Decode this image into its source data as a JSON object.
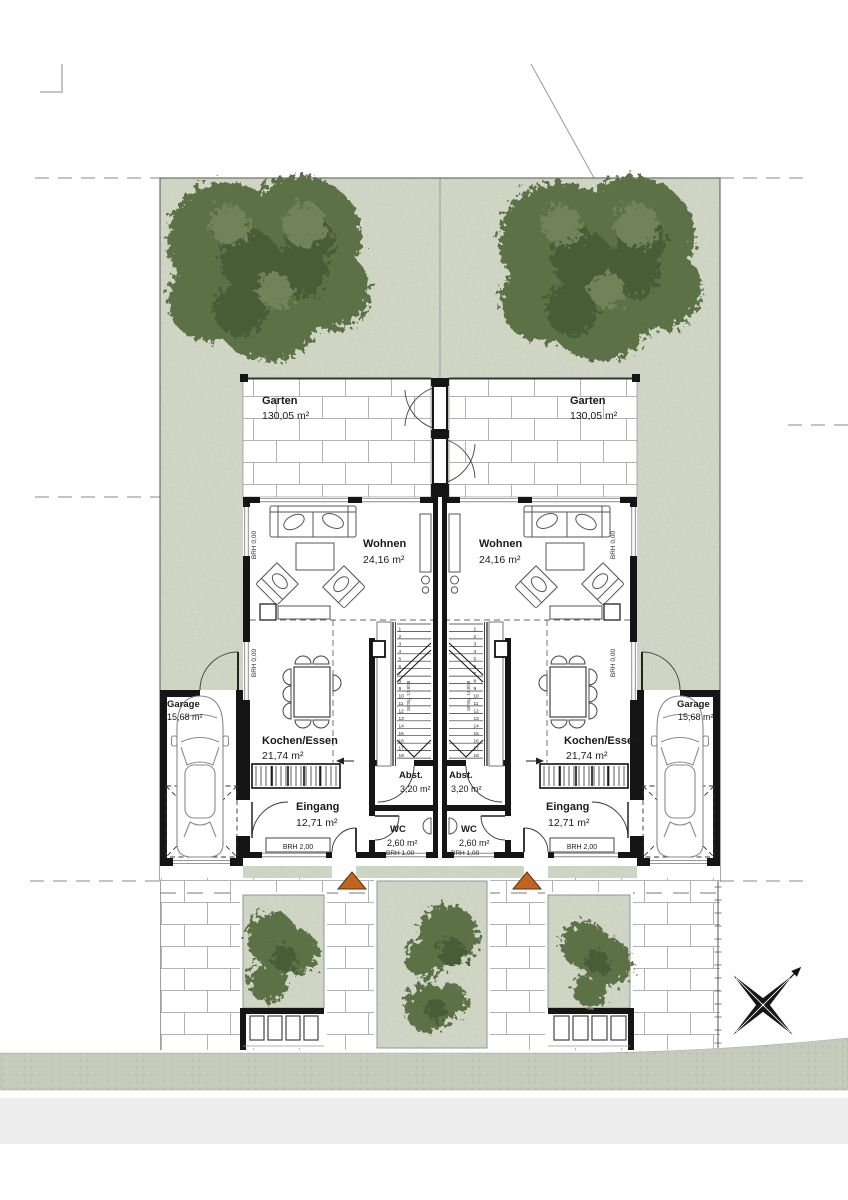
{
  "site": {
    "garden_left": {
      "label": "Garten",
      "area": "130,05 m²"
    },
    "garden_right": {
      "label": "Garten",
      "area": "130,05 m²"
    }
  },
  "units": {
    "left": {
      "wohnen_label": "Wohnen",
      "wohnen_area": "24,16 m²",
      "kochen_label": "Kochen/Essen",
      "kochen_area": "21,74 m²",
      "abst_label": "Abst.",
      "abst_area": "3,20 m²",
      "eingang_label": "Eingang",
      "eingang_area": "12,71 m²",
      "wc_label": "WC",
      "wc_area": "2,60 m²",
      "garage_label": "Garage",
      "garage_area": "15,68 m²",
      "brh_window_a": "BRH 0,00",
      "brh_window_b": "BRH 0,00",
      "brh_wc": "BRH 1,00",
      "brh_front": "BRH 2,00"
    },
    "right": {
      "wohnen_label": "Wohnen",
      "wohnen_area": "24,16 m²",
      "kochen_label": "Kochen/Essen",
      "kochen_area": "21,74 m²",
      "abst_label": "Abst.",
      "abst_area": "3,20 m²",
      "eingang_label": "Eingang",
      "eingang_area": "12,71 m²",
      "wc_label": "WC",
      "wc_area": "2,60 m²",
      "garage_label": "Garage",
      "garage_area": "15,68 m²",
      "brh_window_a": "BRH 0,00",
      "brh_window_b": "BRH 0,00",
      "brh_wc": "BRH 1,00",
      "brh_front": "BRH 2,00"
    }
  },
  "stairs": {
    "steps": [
      "1",
      "2",
      "3",
      "4",
      "5",
      "6",
      "7",
      "8",
      "9",
      "10",
      "11",
      "12",
      "13",
      "14",
      "15",
      "16",
      "17",
      "18"
    ],
    "note": "18 Stg. 17,8/28"
  },
  "colors": {
    "wall": "#151515",
    "grass": "#d4d9c9",
    "tree": "#5d7147",
    "tree_dark": "#4a5c39",
    "entrance_marker": "#c06420",
    "sidewalk": "#c7cbbb",
    "road": "#ededed",
    "brick_joint": "#b3b3b3"
  }
}
